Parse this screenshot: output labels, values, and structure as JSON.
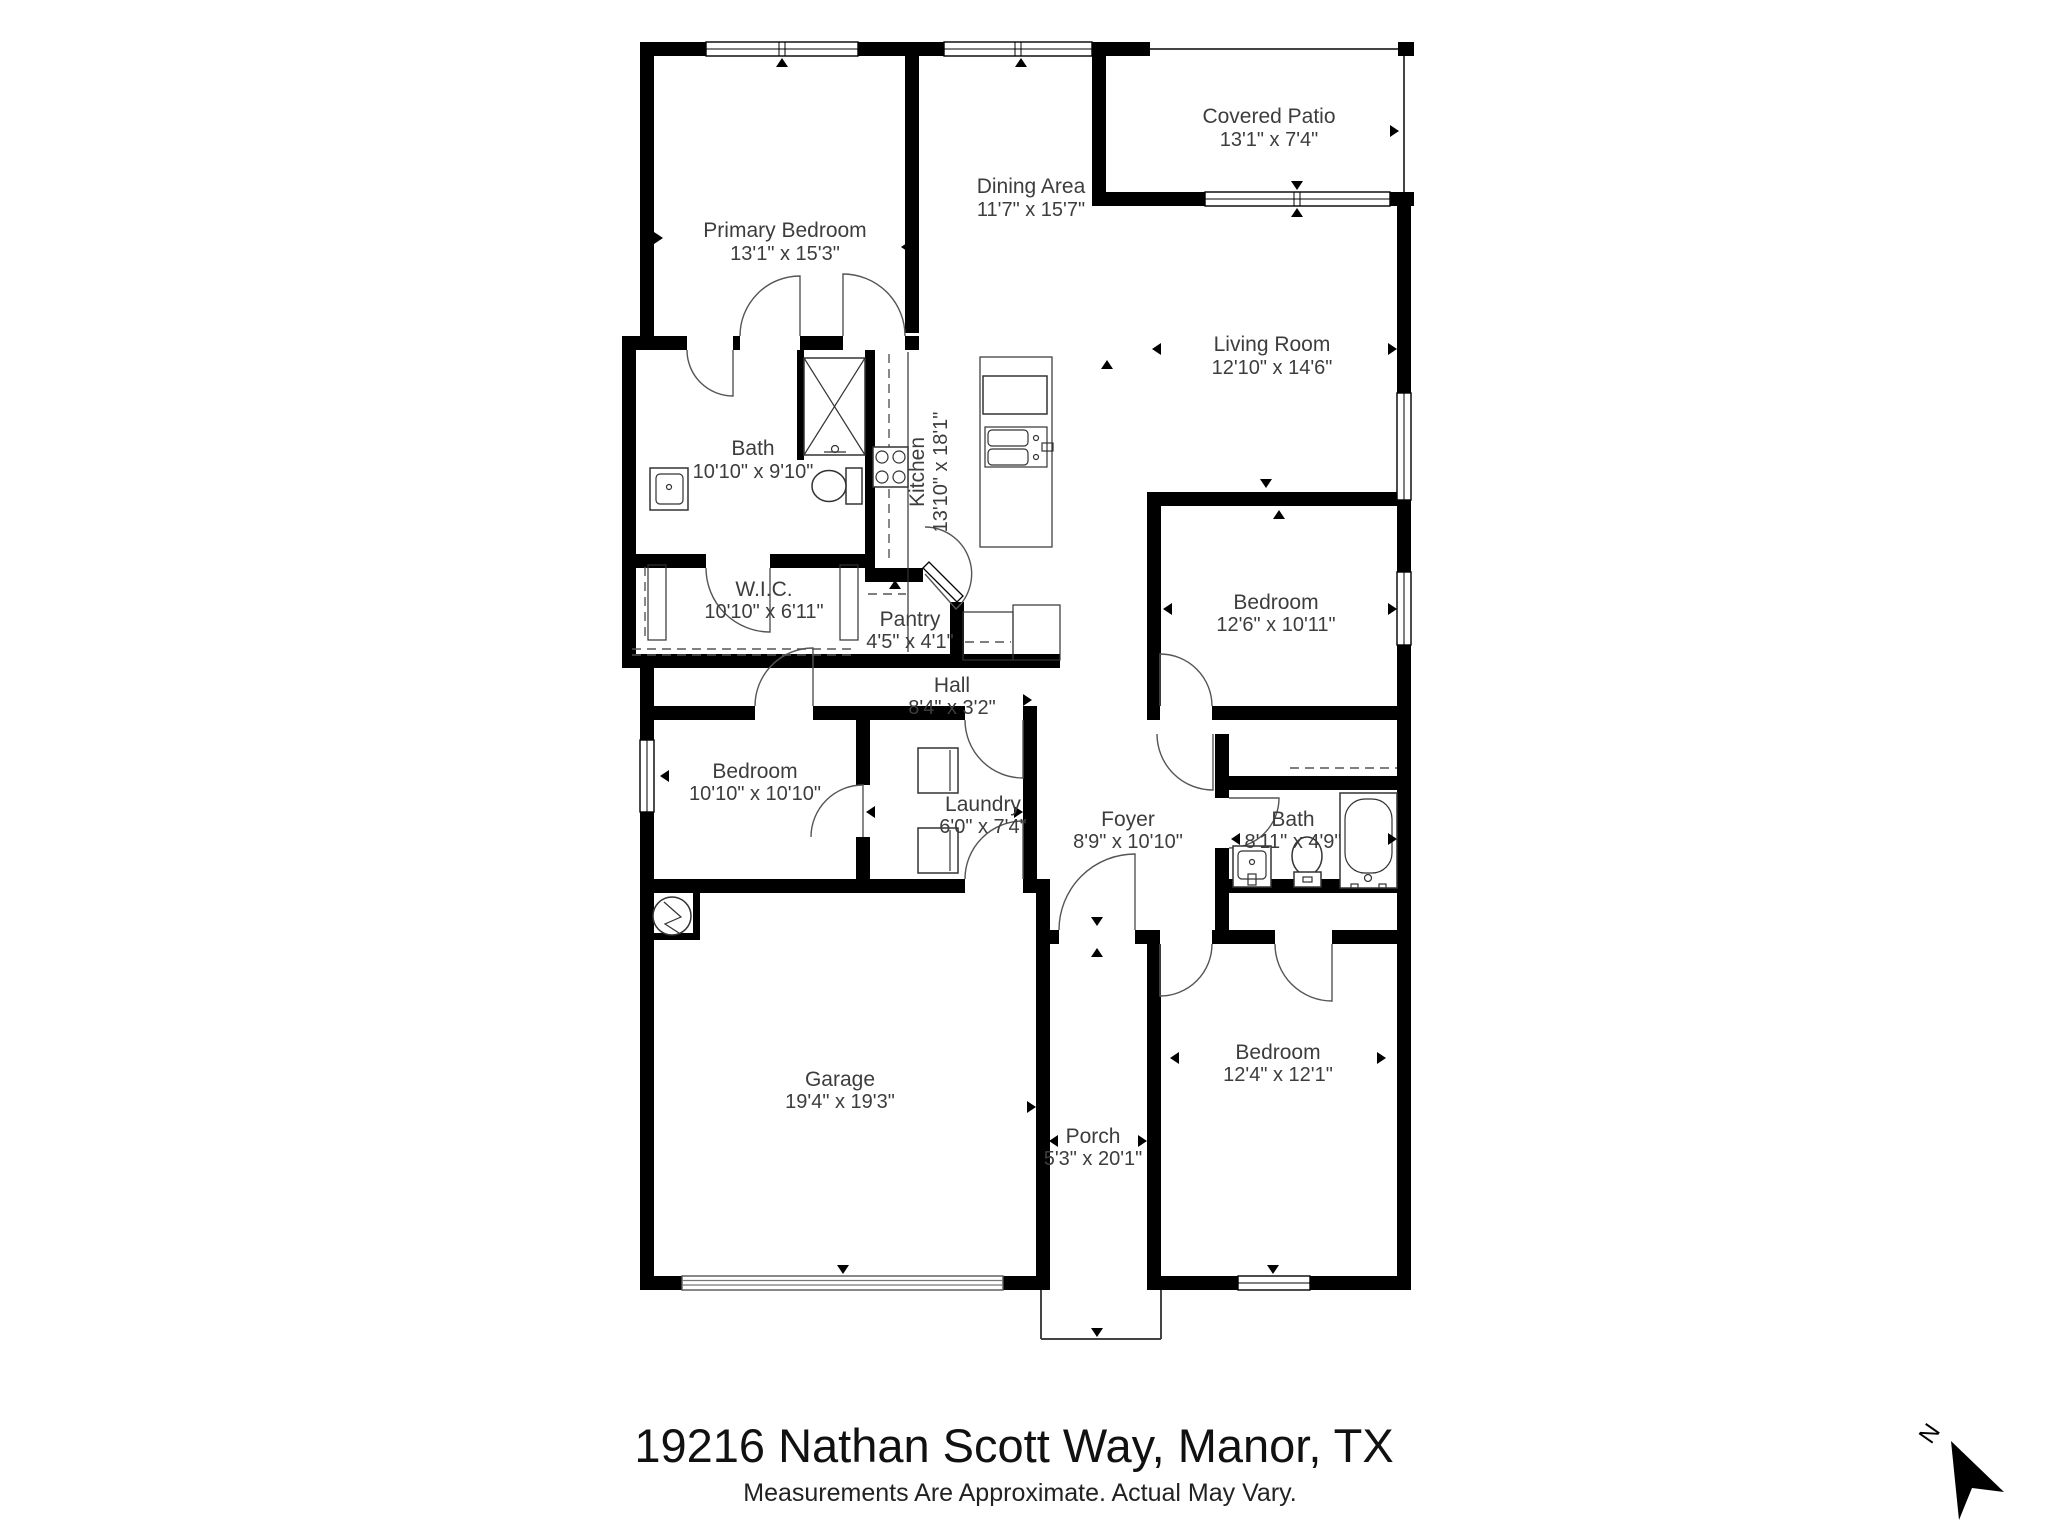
{
  "meta": {
    "address": "19216 Nathan Scott Way, Manor, TX",
    "disclaimer": "Measurements Are Approximate. Actual May Vary.",
    "north_label": "N"
  },
  "rooms": [
    {
      "id": "primary-bedroom",
      "name": "Primary Bedroom",
      "dims": "13'1\" x 15'3\""
    },
    {
      "id": "dining-area",
      "name": "Dining Area",
      "dims": "11'7\" x 15'7\""
    },
    {
      "id": "covered-patio",
      "name": "Covered Patio",
      "dims": "13'1\" x 7'4\""
    },
    {
      "id": "living-room",
      "name": "Living Room",
      "dims": "12'10\" x 14'6\""
    },
    {
      "id": "bath-primary",
      "name": "Bath",
      "dims": "10'10\" x 9'10\""
    },
    {
      "id": "kitchen",
      "name": "Kitchen",
      "dims": "13'10\" x 18'1\""
    },
    {
      "id": "walk-in-closet",
      "name": "W.I.C.",
      "dims": "10'10\" x 6'11\""
    },
    {
      "id": "pantry",
      "name": "Pantry",
      "dims": "4'5\" x 4'1\""
    },
    {
      "id": "hall",
      "name": "Hall",
      "dims": "8'4\" x 3'2\""
    },
    {
      "id": "bedroom-2",
      "name": "Bedroom",
      "dims": "12'6\" x 10'11\""
    },
    {
      "id": "bedroom-3",
      "name": "Bedroom",
      "dims": "10'10\" x 10'10\""
    },
    {
      "id": "laundry",
      "name": "Laundry",
      "dims": "6'0\" x 7'4\""
    },
    {
      "id": "foyer",
      "name": "Foyer",
      "dims": "8'9\" x 10'10\""
    },
    {
      "id": "bath-hall",
      "name": "Bath",
      "dims": "8'11\" x 4'9\""
    },
    {
      "id": "bedroom-4",
      "name": "Bedroom",
      "dims": "12'4\" x 12'1\""
    },
    {
      "id": "garage",
      "name": "Garage",
      "dims": "19'4\" x 19'3\""
    },
    {
      "id": "porch",
      "name": "Porch",
      "dims": "5'3\" x 20'1\""
    }
  ]
}
